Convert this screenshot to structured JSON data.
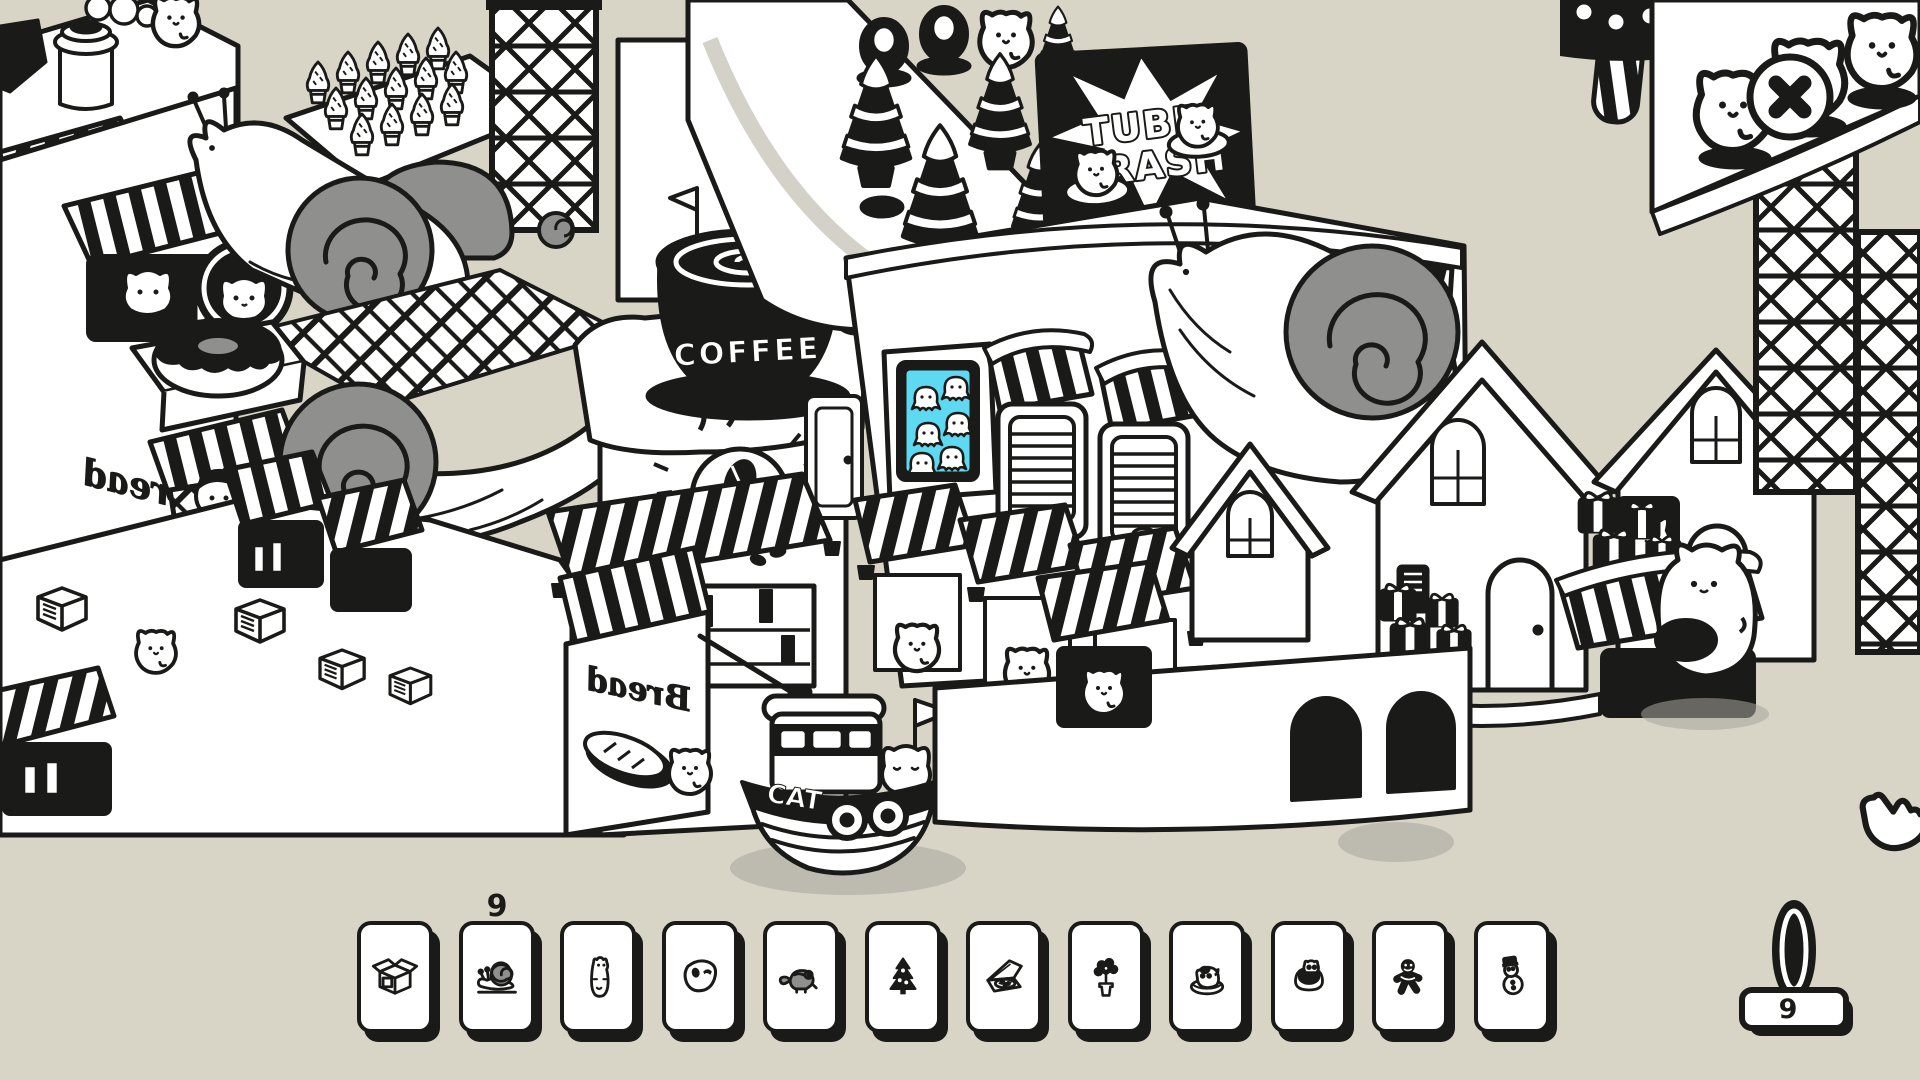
{
  "scene": {
    "billboard": {
      "line1": "TUBE",
      "line2": "CRASH"
    },
    "coffee_cup_label": "COFFEE",
    "coffee_mural_label": "COFFEE",
    "boat_label": "CAT",
    "bread_sign_left": "Bread",
    "bread_sign_lower": "Bread"
  },
  "toolbar": {
    "items": [
      {
        "name": "cardboard-box",
        "count": null
      },
      {
        "name": "snail",
        "count": "9"
      },
      {
        "name": "standing-cat",
        "count": null
      },
      {
        "name": "opera-mask",
        "count": null
      },
      {
        "name": "chameleon",
        "count": null
      },
      {
        "name": "tree-cookie",
        "count": null
      },
      {
        "name": "pizza-box",
        "count": null
      },
      {
        "name": "potted-flowers",
        "count": null
      },
      {
        "name": "cat-in-bed",
        "count": null
      },
      {
        "name": "hamster-in-pot",
        "count": null
      },
      {
        "name": "gingerbread-man",
        "count": null
      },
      {
        "name": "snowman",
        "count": null
      }
    ]
  },
  "counter": {
    "value": "9"
  },
  "colors": {
    "background": "#d8d4c6",
    "ink": "#1a1a18",
    "gray": "#8f8f8d",
    "window_blue": "#5ed9f2",
    "shadow": "#a8a69c"
  }
}
